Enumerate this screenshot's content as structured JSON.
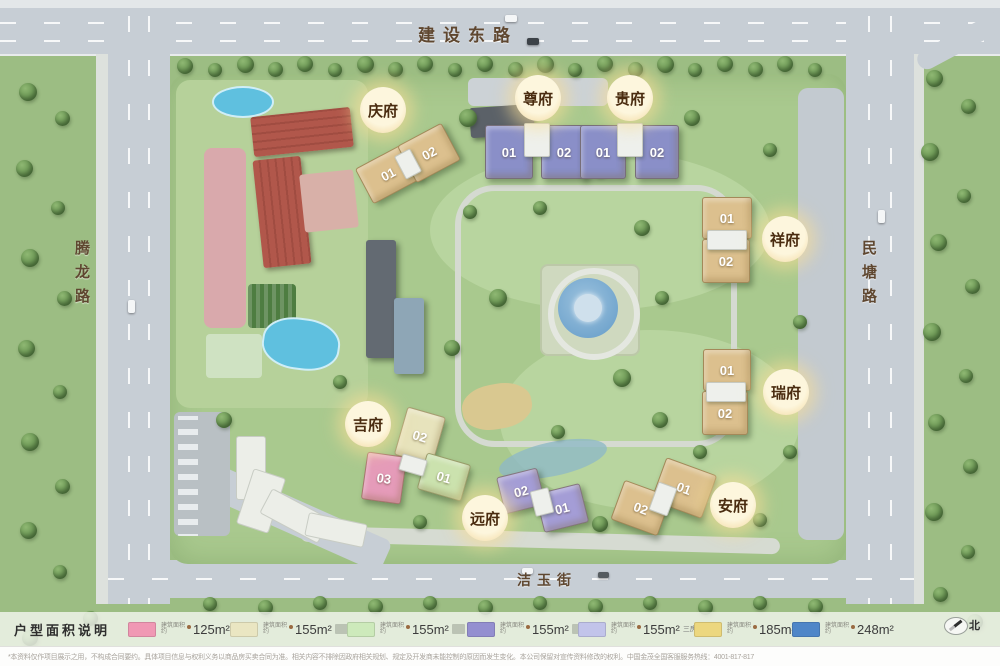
{
  "map": {
    "roads": {
      "top": "建设东路",
      "left": "腾龙路",
      "right": "民塘路",
      "bottom": "洁玉街"
    },
    "north_label": "北"
  },
  "estates": [
    {
      "name": "庆府",
      "units": [
        {
          "no": "01",
          "type": "tan"
        },
        {
          "no": "02",
          "type": "tan"
        }
      ]
    },
    {
      "name": "尊府",
      "units": [
        {
          "no": "01",
          "type": "purple"
        },
        {
          "no": "02",
          "type": "purple"
        }
      ]
    },
    {
      "name": "贵府",
      "units": [
        {
          "no": "01",
          "type": "purple"
        },
        {
          "no": "02",
          "type": "purple"
        }
      ]
    },
    {
      "name": "祥府",
      "units": [
        {
          "no": "01",
          "type": "tan"
        },
        {
          "no": "02",
          "type": "tan"
        }
      ]
    },
    {
      "name": "瑞府",
      "units": [
        {
          "no": "01",
          "type": "tan"
        },
        {
          "no": "02",
          "type": "tan"
        }
      ]
    },
    {
      "name": "安府",
      "units": [
        {
          "no": "01",
          "type": "tan"
        },
        {
          "no": "02",
          "type": "tan"
        }
      ]
    },
    {
      "name": "吉府",
      "units": [
        {
          "no": "02",
          "type": "cream"
        },
        {
          "no": "01",
          "type": "green"
        },
        {
          "no": "03",
          "type": "pink"
        }
      ]
    },
    {
      "name": "远府",
      "units": [
        {
          "no": "02",
          "type": "violet"
        },
        {
          "no": "01",
          "type": "violet"
        }
      ]
    }
  ],
  "building_colors": {
    "tan": "#dcc08e",
    "purple": "#8a8fc8",
    "cream": "#e7e3bc",
    "green": "#cbe2ae",
    "pink": "#e59bb9",
    "violet": "#a49dd6"
  },
  "legend": {
    "title": "户型面积说明",
    "area_prefix": "建筑面积约",
    "items": [
      {
        "swatch": "#f098b4",
        "area": "125m²",
        "note": "",
        "note_illegible": false
      },
      {
        "swatch": "#eae6c2",
        "area": "155m²",
        "note": "",
        "note_illegible": true
      },
      {
        "swatch": "#cdeabb",
        "area": "155m²",
        "note": "",
        "note_illegible": true
      },
      {
        "swatch": "#948fd0",
        "area": "155m²",
        "note": "",
        "note_illegible": true
      },
      {
        "swatch": "#c2c4ea",
        "area": "155m²",
        "note": "三房",
        "note_illegible": false
      },
      {
        "swatch": "#ecd77f",
        "area": "185m²",
        "note": "",
        "note_illegible": false
      },
      {
        "swatch": "#4f86c8",
        "area": "248m²",
        "note": "",
        "note_illegible": false
      }
    ]
  },
  "footer": {
    "disclaimer": "*本资料仅作项目展示之用，不构成合同要约。具体项目信息与权利义务以商品房买卖合同为准。相关内容不排除因政府相关规划、规定及开发商未能控制的原因而发生变化。本公司保留对宣传资料修改的权利。中国金茂全国客服服务热线：4001-817-817"
  }
}
